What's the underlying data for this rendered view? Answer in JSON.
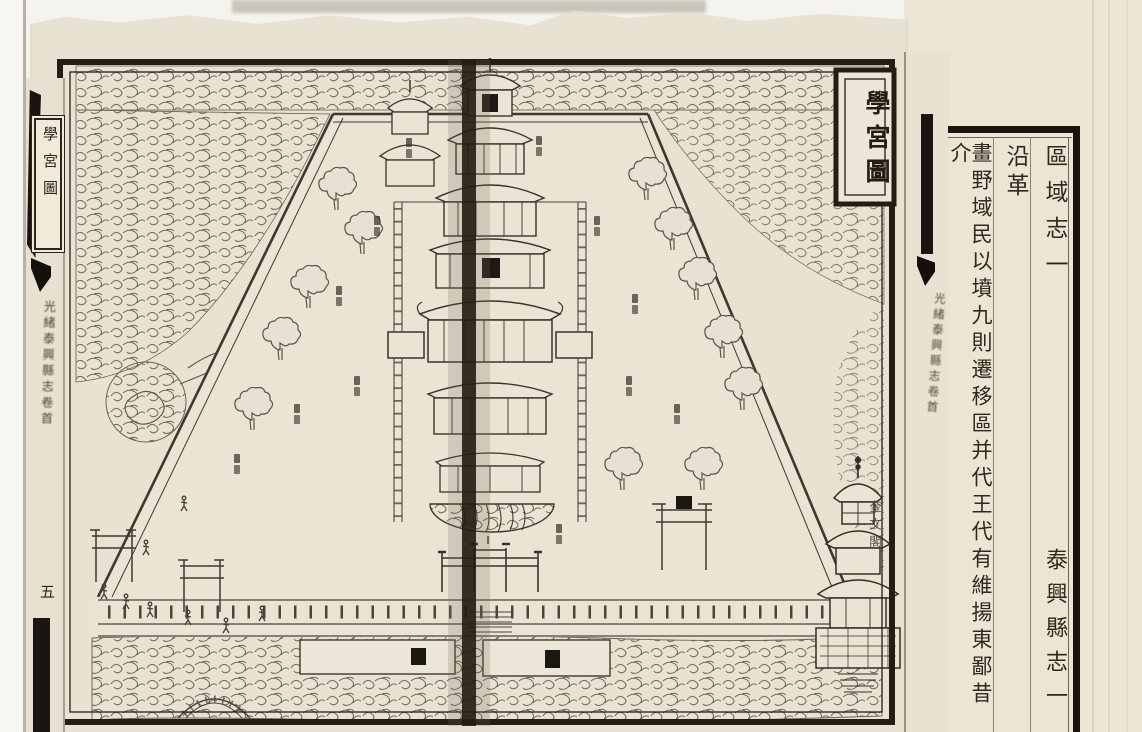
{
  "map_page": {
    "title_plate": "學宮圖",
    "pavilion_label": "奎文閣"
  },
  "left_spine": {
    "title_plate": "學宮圖",
    "caption": "光緒泰興縣志卷首",
    "page_number": "五"
  },
  "center_spine": {
    "caption": "光緒泰興縣志卷首"
  },
  "text_page": {
    "section_title": "區域志一",
    "chapter_heading": "沿革",
    "body_column": "畫野域民以墳九則遷移區并代王代有維揚東鄙昔介",
    "volume_footer": "泰興縣志一"
  }
}
